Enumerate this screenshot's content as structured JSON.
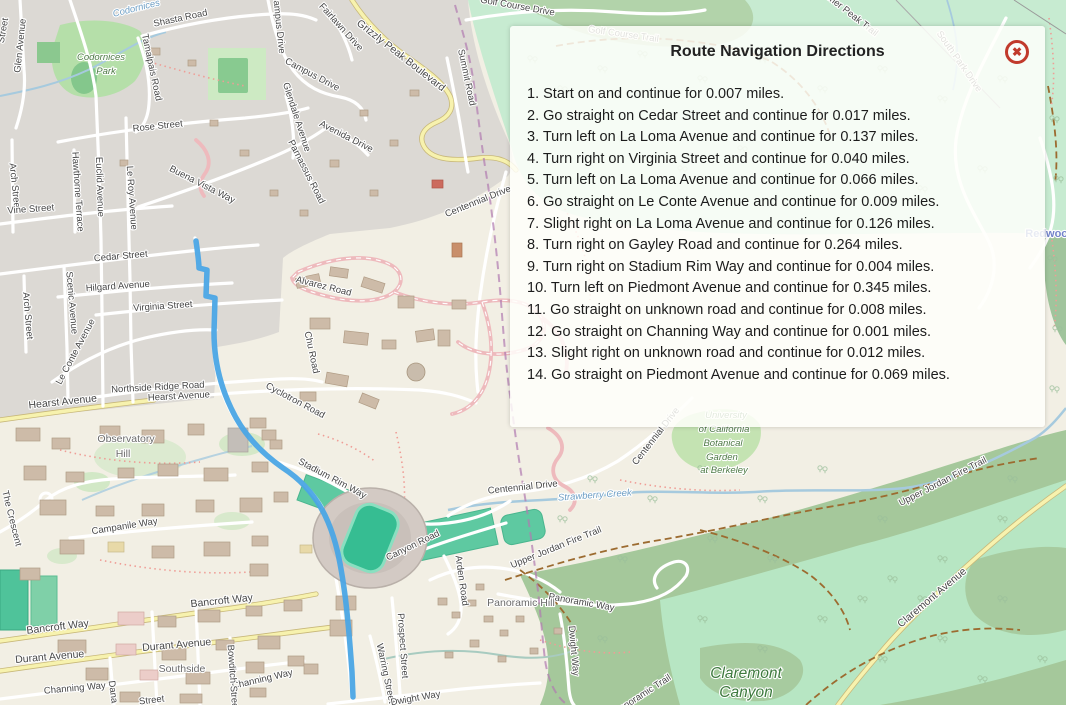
{
  "panel": {
    "title": "Route Navigation Directions",
    "close_icon": "circled-x",
    "close_glyph": "✖",
    "steps": [
      "1. Start on and continue for 0.007 miles.",
      "2. Go straight on Cedar Street and continue for 0.017 miles.",
      "3. Turn left on La Loma Avenue and continue for 0.137 miles.",
      "4. Turn right on Virginia Street and continue for 0.040 miles.",
      "5. Turn left on La Loma Avenue and continue for 0.066 miles.",
      "6. Go straight on Le Conte Avenue and continue for 0.009 miles.",
      "7. Slight right on La Loma Avenue and continue for 0.126 miles.",
      "8. Turn right on Gayley Road and continue for 0.264 miles.",
      "9. Turn right on Stadium Rim Way and continue for 0.004 miles.",
      "10. Turn left on Piedmont Avenue and continue for 0.345 miles.",
      "11. Go straight on unknown road and continue for 0.008 miles.",
      "12. Go straight on Channing Way and continue for 0.001 miles.",
      "13. Slight right on unknown road and continue for 0.012 miles.",
      "14. Go straight on Piedmont Avenue and continue for 0.069 miles."
    ]
  },
  "map": {
    "labels": [
      "Codornices",
      "Codornices",
      "Park",
      "Shasta Road",
      "Tamalpais Road",
      "Campus Drive",
      "Campus Drive",
      "Glendale Avenue",
      "Rose Street",
      "Buena Vista Way",
      "Euclid Avenue",
      "Le Roy Avenue",
      "Hawthorne Terrace",
      "Arch Street",
      "Vine Street",
      "Parnassus Road",
      "Avenida Drive",
      "Fairlawn Drive",
      "Grizzly Peak Boulevard",
      "Summit Road",
      "Golf Course Drive",
      "Vollmer Peak Trail",
      "Golf Course Trail",
      "South Park Drive",
      "Redwood",
      "Glen Avenue",
      "Street",
      "Cedar Street",
      "Hilgard Avenue",
      "Virginia Street",
      "Le Conte Avenue",
      "Northside Ridge Road",
      "Hearst Avenue",
      "Hearst Avenue",
      "Scenic Avenue",
      "Arch Street",
      "Observatory",
      "Hill",
      "The Crescent",
      "Campanile Way",
      "Bancroft Way",
      "Bancroft Way",
      "Durant Avenue",
      "Durant Avenue",
      "Southside",
      "Channing Way",
      "Channing Way",
      "Dana St",
      "Bowditch Street",
      "Alvarez Road",
      "Chu Road",
      "Cyclotron Road",
      "Stadium Rim Way",
      "Canyon Road",
      "Centennial Drive",
      "Centennial Drive",
      "Centennial Drive",
      "Strawberry Creek",
      "University",
      "of California",
      "Botanical",
      "Garden",
      "at Berkeley",
      "Upper Jordan Fire Trail",
      "Upper Jordan Fire Trail",
      "Panoramic Hill",
      "Panoramic Way",
      "Arden Road",
      "Prospect Street",
      "Warring Street",
      "Dwight Way",
      "Dwight Way",
      "Panoramic Trail",
      "Claremont",
      "Canyon",
      "Claremont Avenue",
      "Street"
    ]
  },
  "colors": {
    "route_blue": "#4aa5e5",
    "close_red": "#c13a2c",
    "secondary_road_yellow": "#f7f2ae",
    "urban_gray": "#dcd9d4",
    "campus_cream": "#f2efe4",
    "mint_green": "#c7ebd1",
    "forest_green": "#a5c89b",
    "canyon_mint": "#b7e6c3",
    "field_teal": "#5ec9a1",
    "boundary_purple": "#b07ab0"
  }
}
